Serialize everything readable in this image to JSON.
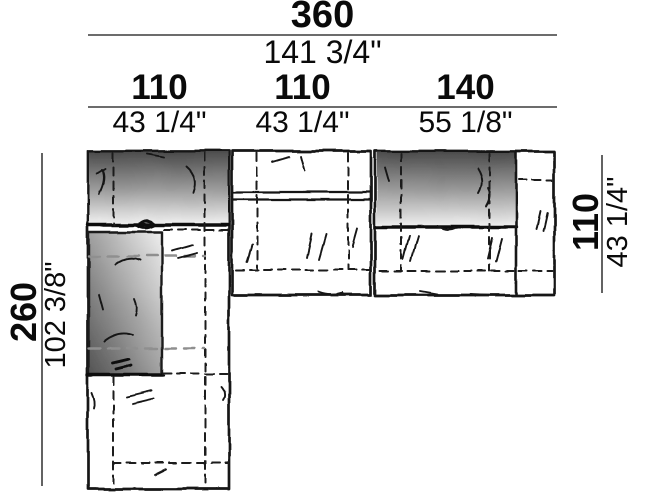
{
  "diagram": {
    "overall_width": {
      "metric": "360",
      "imperial": "141 3/4\""
    },
    "segments": [
      {
        "metric": "110",
        "imperial": "43 1/4\""
      },
      {
        "metric": "110",
        "imperial": "43 1/4\""
      },
      {
        "metric": "140",
        "imperial": "55 1/8\""
      }
    ],
    "overall_depth_left": {
      "metric": "260",
      "imperial": "102 3/8\""
    },
    "depth_right": {
      "metric": "110",
      "imperial": "43 1/4\""
    },
    "colors": {
      "outline": "#161616",
      "dimension_line": "#3c3c3c",
      "backrest_dark": "#4c4c4c",
      "backrest_light": "#f2f2f2",
      "hidden_line_gray": "#8f8f8f",
      "background": "#ffffff"
    }
  }
}
